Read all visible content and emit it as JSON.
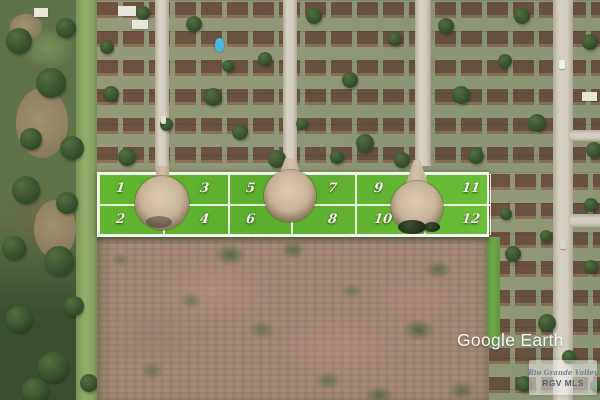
{
  "image": {
    "watermark": "Google Earth",
    "lot_numbers": [
      "1",
      "2",
      "3",
      "4",
      "5",
      "6",
      "7",
      "8",
      "9",
      "10",
      "11",
      "12"
    ],
    "logo": {
      "line1": "Rio Grande Valley",
      "line2": "RGV MLS"
    },
    "colors": {
      "lot_overlay_green": "#61b82c",
      "lot_grid_white": "#ffffff",
      "lot_number_text": "#f7f4ea",
      "culdesac_dirt": "#ccb59a",
      "field_brown": "#a68b76",
      "watermark_white": "#ffffff",
      "pool_blue": "#49b7dd"
    }
  }
}
